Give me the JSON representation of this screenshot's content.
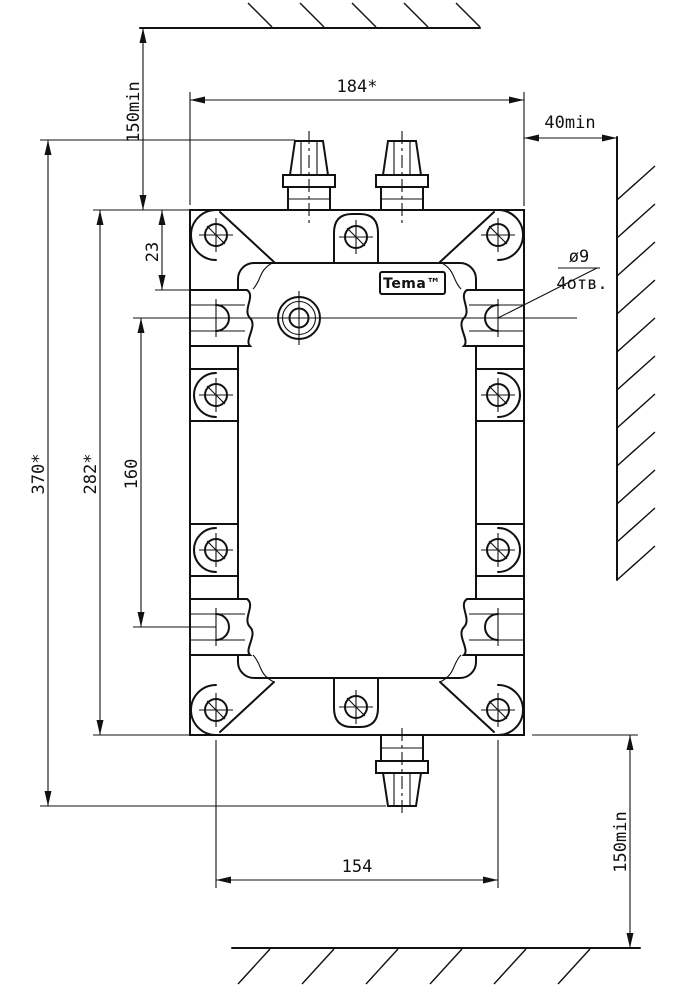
{
  "drawing": {
    "logo_label": "Tema™",
    "dimensions": {
      "top_clearance": "150min",
      "overall_width": "184*",
      "side_clearance": "40min",
      "slot_top_offset": "23",
      "overall_height": "370*",
      "body_height": "282*",
      "slot_vertical_spacing": "160",
      "slot_horizontal_spacing": "154",
      "bottom_clearance": "150min"
    },
    "hole_note": {
      "diameter": "ø9",
      "count": "4отв."
    }
  }
}
